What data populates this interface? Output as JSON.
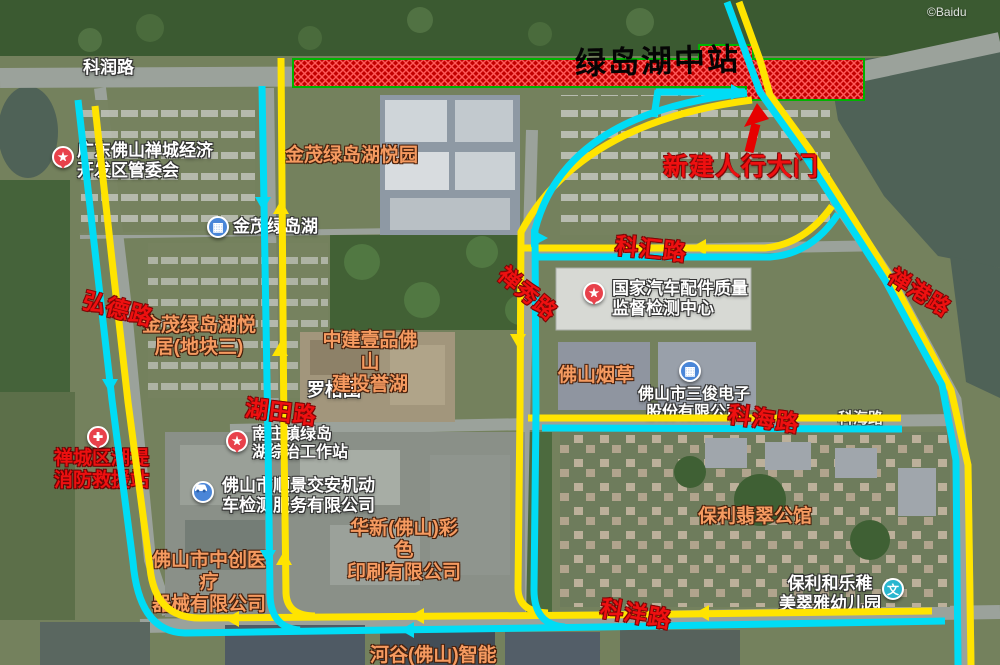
{
  "colors": {
    "route_yellow": "#ffe400",
    "route_cyan": "#00dcf5",
    "annotation_red": "#ee1010",
    "zone_red": "#c20000",
    "zone_hatch": "#ff5a5a",
    "zone_border_green": "#00b400"
  },
  "station_zone": {
    "label": "绿岛湖中站"
  },
  "gate_annotation": {
    "label": "新建人行大门"
  },
  "road_labels_red": [
    {
      "text": "弘德路"
    },
    {
      "text": "湖田路"
    },
    {
      "text": "科汇路"
    },
    {
      "text": "禅秀路"
    },
    {
      "text": "禅港路"
    },
    {
      "text": "科海路"
    },
    {
      "text": "科洋路"
    }
  ],
  "road_labels_base": [
    {
      "text": "科润路"
    },
    {
      "text": "科海路"
    }
  ],
  "poi_labels": [
    {
      "text": "广东佛山禅城经济\n开发区管委会",
      "icon": "star-pin"
    },
    {
      "text": "金茂绿岛湖",
      "icon": "building"
    },
    {
      "text": "罗格围",
      "icon": "none"
    },
    {
      "text": "国家汽车配件质量\n监督检测中心",
      "icon": "star-pin"
    },
    {
      "text": "佛山市三俊电子\n股份有限公司",
      "icon": "building"
    },
    {
      "text": "保利和乐稚\n美翠雅幼儿园",
      "icon": "school"
    },
    {
      "text": "佛山市顺景交安机动\n车检测服务有限公司",
      "icon": "car"
    },
    {
      "text": "南庄镇绿岛\n湖综治工作站",
      "icon": "star-pin"
    },
    {
      "text": "禅城区湖堤\n消防救援站",
      "icon": "rescue"
    }
  ],
  "estate_labels": [
    {
      "text": "金茂绿岛湖悦园"
    },
    {
      "text": "金茂绿岛湖悦\n居(地块三)"
    },
    {
      "text": "中建壹品佛山\n建投誉湖"
    },
    {
      "text": "佛山烟草"
    },
    {
      "text": "华新(佛山)彩色\n印刷有限公司"
    },
    {
      "text": "佛山市中创医疗\n器械有限公司"
    },
    {
      "text": "保利翡翠公馆"
    },
    {
      "text": "河谷(佛山)智能"
    }
  ],
  "watermark": "©Baidu",
  "poi_icon_glyphs": {
    "star": "★",
    "building": "▦",
    "school": "文",
    "rescue": "✚"
  }
}
